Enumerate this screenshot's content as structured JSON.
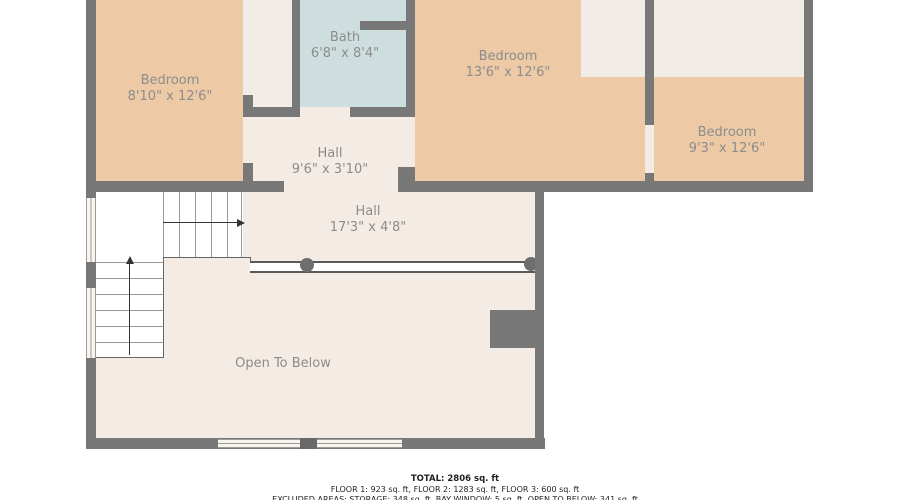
{
  "plan": {
    "rooms": [
      {
        "id": "bedroom-left",
        "name": "Bedroom",
        "dims": "8'10\" x 12'6\""
      },
      {
        "id": "bath",
        "name": "Bath",
        "dims": "6'8\" x 8'4\""
      },
      {
        "id": "bedroom-middle",
        "name": "Bedroom",
        "dims": "13'6\" x 12'6\""
      },
      {
        "id": "bedroom-right",
        "name": "Bedroom",
        "dims": "9'3\" x 12'6\""
      },
      {
        "id": "hall-upper",
        "name": "Hall",
        "dims": "9'6\" x 3'10\""
      },
      {
        "id": "hall-lower",
        "name": "Hall",
        "dims": "17'3\" x 4'8\""
      },
      {
        "id": "open-to-below",
        "name": "Open To Below",
        "dims": ""
      }
    ],
    "colors": {
      "room_tan": "#edcaa5",
      "bath_blue": "#cedddd",
      "hall_cream": "#f3ebe4",
      "wall_gray": "#787878"
    },
    "footer": {
      "total": "TOTAL: 2806 sq. ft",
      "floors": "FLOOR 1: 923 sq. ft, FLOOR 2: 1283 sq. ft, FLOOR 3: 600 sq. ft",
      "excluded": "EXCLUDED AREAS: STORAGE: 348 sq. ft, BAY WINDOW: 5 sq. ft, OPEN TO BELOW: 341 sq. ft"
    }
  }
}
